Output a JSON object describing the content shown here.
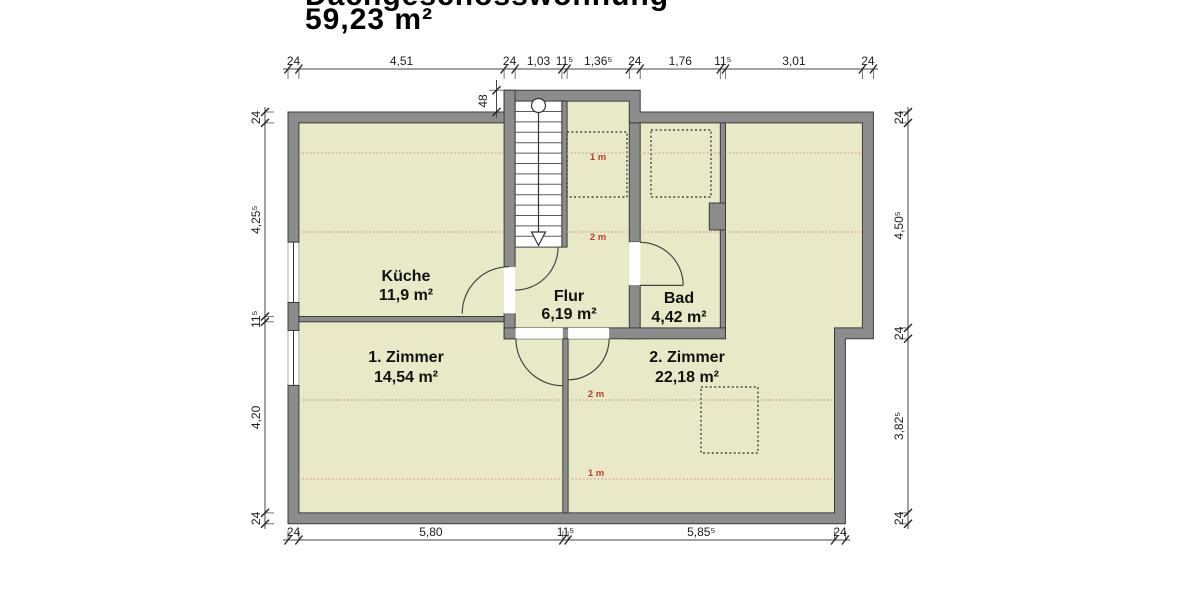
{
  "title": {
    "line1": "Dachgeschosswohnung",
    "line2": "59,23 m²"
  },
  "rooms": {
    "kueche": {
      "name": "Küche",
      "area": "11,9 m²"
    },
    "flur": {
      "name": "Flur",
      "area": "6,19 m²"
    },
    "bad": {
      "name": "Bad",
      "area": "4,42 m²"
    },
    "zimmer1": {
      "name": "1. Zimmer",
      "area": "14,54 m²"
    },
    "zimmer2": {
      "name": "2. Zimmer",
      "area": "22,18 m²"
    }
  },
  "dimensions": {
    "top": [
      "24",
      "4,51",
      "24",
      "1,03",
      "11⁵",
      "1,36⁵",
      "24",
      "1,76",
      "11⁵",
      "3,01",
      "24"
    ],
    "bottom": [
      "24",
      "5,80",
      "11⁵",
      "5,85⁵",
      "24"
    ],
    "left": [
      "24",
      "4,25⁵",
      "11⁵",
      "4,20",
      "24"
    ],
    "right": [
      "24",
      "4,50⁵",
      "24",
      "3,82⁵",
      "24"
    ],
    "stair_offset": "48"
  },
  "roof_height_labels": {
    "one_meter": "1 m",
    "two_meter": "2 m"
  },
  "colors": {
    "wall": "#8c8c8c",
    "floor": "#e9e9c8",
    "roof_line": "#d0a087",
    "roof_label": "#b5432a"
  }
}
